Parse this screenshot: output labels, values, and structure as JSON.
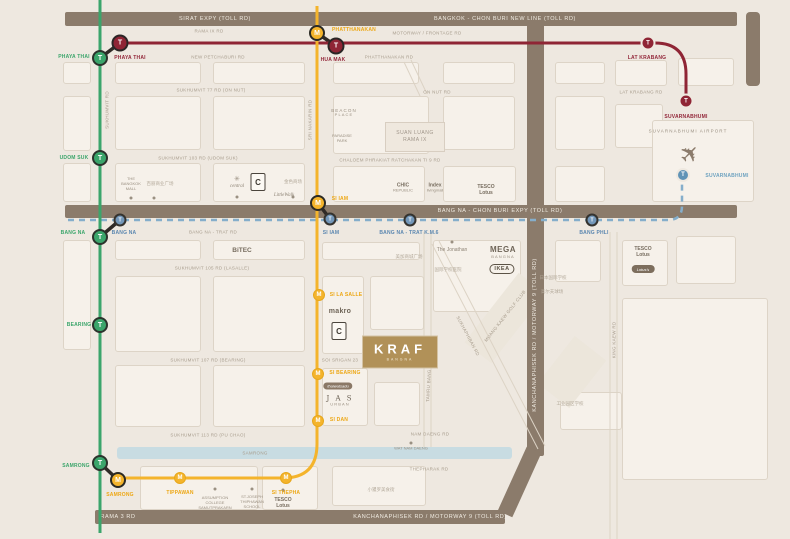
{
  "map": {
    "colors": {
      "green_line": "#3ba56b",
      "yellow_line": "#f4b42c",
      "airport_link": "#8f2535",
      "lrt_dashed": "#85aecb",
      "toll_road": "#8b7b6b",
      "brand_gold": "#b19158",
      "canal": "#c8dce2"
    },
    "bars": {
      "top_left": "SIRAT EXPY (TOLL RD)",
      "top_right": "BANGKOK - CHON BURI NEW LINE (TOLL RD)",
      "middle": "BANG NA - CHON BURI EXPY (TOLL RD)",
      "vertical": "KANCHANAPHISEK RD / MOTORWAY 9 (TOLL RD)",
      "bottom_left": "RAMA 3 RD",
      "bottom_right": "KANCHANAPHISEK RD / MOTORWAY 9 (TOLL RD)"
    },
    "logos": {
      "kraf": "KRAF",
      "kraf_sub": "BANGNA",
      "suan1": "SUAN LUANG",
      "suan2": "RAMA IX",
      "ikea": "IKEA",
      "bigc": "C",
      "lotus_oval": "Lotus's",
      "thaiwatsadu": "thaiwatsadu"
    },
    "icons": {
      "plane": "✈"
    },
    "streets": [
      {
        "t": "RAMA IX RD",
        "x": 209,
        "y": 31
      },
      {
        "t": "MOTORWAY / FRONTAGE RD",
        "x": 427,
        "y": 33
      },
      {
        "t": "NEW PETCHABURI RD",
        "x": 218,
        "y": 57
      },
      {
        "t": "PHATTHANAKAN RD",
        "x": 389,
        "y": 57
      },
      {
        "t": "SUKHUMVIT 77 RD (ON NUT)",
        "x": 211,
        "y": 90
      },
      {
        "t": "ON NUT RD",
        "x": 437,
        "y": 92
      },
      {
        "t": "LAT KRABANG RD",
        "x": 641,
        "y": 92
      },
      {
        "t": "SUKHUMVIT 103 RD (UDOM SUK)",
        "x": 198,
        "y": 158
      },
      {
        "t": "CHALOEM PHRAKIAT RATCHAKAN TI 9 RD",
        "x": 390,
        "y": 160
      },
      {
        "t": "BANG NA - TRAT RD",
        "x": 213,
        "y": 232
      },
      {
        "t": "SUKHUMVIT 105 RD (LASALLE)",
        "x": 212,
        "y": 268
      },
      {
        "t": "SUKHUMVIT 107 RD (BEARING)",
        "x": 208,
        "y": 360
      },
      {
        "t": "SOI SRIGAN 23",
        "x": 340,
        "y": 360
      },
      {
        "t": "SUKHUMVIT 113 RD (PU CHAO)",
        "x": 208,
        "y": 435
      },
      {
        "t": "NAM DAENG RD",
        "x": 430,
        "y": 434
      },
      {
        "t": "THEPHARAK RD",
        "x": 429,
        "y": 469
      },
      {
        "t": "SAMRONG",
        "x": 255,
        "y": 453
      },
      {
        "t": "SUKHUMVIT RD",
        "x": 107,
        "y": 110,
        "r": -90
      },
      {
        "t": "SRI NAKARIN RD",
        "x": 310,
        "y": 120,
        "r": -90
      },
      {
        "t": "TAMRU BANG PLA RD",
        "x": 429,
        "y": 376,
        "r": -87
      },
      {
        "t": "KING KAEW RD",
        "x": 614,
        "y": 340,
        "r": -90
      },
      {
        "t": "SUKHAPHIBAN RD",
        "x": 468,
        "y": 336,
        "r": 62
      },
      {
        "t": "MUANG KAEW GOLF CLUB",
        "x": 505,
        "y": 316,
        "r": -52
      }
    ],
    "stations": [
      {
        "id": "phaya-thai-bts",
        "t": "bts",
        "g": "T",
        "x": 100,
        "y": 58,
        "l": {
          "t": "PHAYA THAI",
          "x": 74,
          "y": 57,
          "c": "lg"
        }
      },
      {
        "id": "udom-suk",
        "t": "bts",
        "g": "T",
        "x": 100,
        "y": 158,
        "l": {
          "t": "UDOM SUK",
          "x": 74,
          "y": 158,
          "c": "lg"
        }
      },
      {
        "id": "bang-na-bts",
        "t": "bts",
        "g": "T",
        "x": 100,
        "y": 237,
        "l": {
          "t": "BANG NA",
          "x": 73,
          "y": 233,
          "c": "lg"
        }
      },
      {
        "id": "bearing",
        "t": "bts",
        "g": "T",
        "x": 100,
        "y": 325,
        "l": {
          "t": "BEARING",
          "x": 79,
          "y": 325,
          "c": "lg"
        }
      },
      {
        "id": "samrong-bts",
        "t": "bts",
        "g": "T",
        "x": 100,
        "y": 463,
        "l": {
          "t": "SAMRONG",
          "x": 76,
          "y": 466,
          "c": "lg"
        }
      },
      {
        "id": "phaya-thai-arl",
        "t": "arl",
        "g": "T",
        "x": 120,
        "y": 43,
        "l": {
          "t": "PHAYA THAI",
          "x": 130,
          "y": 58,
          "c": "lr"
        }
      },
      {
        "id": "hua-mak-arl",
        "t": "arl",
        "g": "T",
        "x": 336,
        "y": 46,
        "l": {
          "t": "HUA MAK",
          "x": 333,
          "y": 60,
          "c": "lr"
        }
      },
      {
        "id": "lat-krabang-arl",
        "t": "arl2",
        "g": "T",
        "x": 648,
        "y": 43,
        "l": {
          "t": "LAT KRABANG",
          "x": 647,
          "y": 58,
          "c": "lr"
        }
      },
      {
        "id": "suvarnabhumi-arl",
        "t": "arl2",
        "g": "T",
        "x": 686,
        "y": 101,
        "l": {
          "t": "SUVARNABHUMI",
          "x": 686,
          "y": 117,
          "c": "lr"
        }
      },
      {
        "id": "phatthanakan",
        "t": "m",
        "g": "M",
        "x": 317,
        "y": 33,
        "l": {
          "t": "PHATTHANAKAN",
          "x": 354,
          "y": 30,
          "c": "lo"
        }
      },
      {
        "id": "si-iam-m",
        "t": "m",
        "g": "M",
        "x": 318,
        "y": 203,
        "l": {
          "t": "SI IAM",
          "x": 340,
          "y": 199,
          "c": "lo"
        }
      },
      {
        "id": "si-la-salle",
        "t": "m2",
        "g": "M",
        "x": 319,
        "y": 295,
        "l": {
          "t": "SI LA SALLE",
          "x": 346,
          "y": 295,
          "c": "lo"
        }
      },
      {
        "id": "si-bearing",
        "t": "m2",
        "g": "M",
        "x": 318,
        "y": 374,
        "l": {
          "t": "SI BEARING",
          "x": 345,
          "y": 373,
          "c": "lo"
        }
      },
      {
        "id": "si-dan",
        "t": "m2",
        "g": "M",
        "x": 318,
        "y": 421,
        "l": {
          "t": "SI DAN",
          "x": 339,
          "y": 420,
          "c": "lo"
        }
      },
      {
        "id": "si-thepha",
        "t": "m2",
        "g": "M",
        "x": 286,
        "y": 478,
        "l": {
          "t": "SI THEPHA",
          "x": 286,
          "y": 493,
          "c": "lo"
        }
      },
      {
        "id": "tippawan",
        "t": "m2",
        "g": "M",
        "x": 180,
        "y": 478,
        "l": {
          "t": "TIPPAWAN",
          "x": 180,
          "y": 493,
          "c": "lo"
        }
      },
      {
        "id": "samrong-m",
        "t": "m",
        "g": "M",
        "x": 118,
        "y": 480,
        "l": {
          "t": "SAMRONG",
          "x": 120,
          "y": 495,
          "c": "lo"
        }
      },
      {
        "id": "bang-na-lrt",
        "t": "lrt",
        "g": "T",
        "x": 120,
        "y": 220,
        "l": {
          "t": "BANG NA",
          "x": 124,
          "y": 233,
          "c": "lb"
        }
      },
      {
        "id": "si-iam-lrt",
        "t": "lrt",
        "g": "T",
        "x": 330,
        "y": 219,
        "l": {
          "t": "SI IAM",
          "x": 331,
          "y": 233,
          "c": "lb"
        }
      },
      {
        "id": "bangna-trat-km6",
        "t": "lrt",
        "g": "T",
        "x": 410,
        "y": 220,
        "l": {
          "t": "BANG NA - TRAT K.M.6",
          "x": 409,
          "y": 233,
          "c": "lb"
        }
      },
      {
        "id": "bang-phli",
        "t": "lrt",
        "g": "T",
        "x": 592,
        "y": 220,
        "l": {
          "t": "BANG PHLI",
          "x": 594,
          "y": 233,
          "c": "lb"
        }
      },
      {
        "id": "suvarnabhumi-city",
        "t": "city",
        "g": "T",
        "x": 683,
        "y": 175,
        "l": {
          "t": "SUVARNABHUMI",
          "x": 727,
          "y": 176,
          "c": "lc"
        }
      }
    ],
    "pois": [
      {
        "n": "the-bangkok-mall",
        "x": 131,
        "y": 184,
        "lines": [
          {
            "t": "THE",
            "c": "t4"
          },
          {
            "t": "BANGKOK",
            "c": "t4"
          },
          {
            "t": "MALL",
            "c": "t4"
          }
        ]
      },
      {
        "n": "central",
        "x": 237,
        "y": 183,
        "lines": [
          {
            "t": "✳",
            "c": "flower"
          },
          {
            "t": "central",
            "c": "it"
          }
        ]
      },
      {
        "n": "little-walk",
        "x": 284,
        "y": 196,
        "lines": [
          {
            "t": "LittleWalk",
            "c": "it"
          }
        ]
      },
      {
        "n": "beacon-place",
        "x": 344,
        "y": 113,
        "lines": [
          {
            "t": "BEACON",
            "c": "t45 sp"
          },
          {
            "t": "PLACE",
            "c": "t4 sp"
          }
        ]
      },
      {
        "n": "paradise-park",
        "x": 342,
        "y": 139,
        "lines": [
          {
            "t": "PARADISE",
            "c": "t4"
          },
          {
            "t": "PARK",
            "c": "t4"
          }
        ]
      },
      {
        "n": "chic-republic",
        "x": 403,
        "y": 188,
        "lines": [
          {
            "t": "CHIC",
            "c": "b5"
          },
          {
            "t": "REPUBLIC",
            "c": "t4"
          }
        ]
      },
      {
        "n": "index-livingmall",
        "x": 435,
        "y": 188,
        "lines": [
          {
            "t": "Index",
            "c": "b5"
          },
          {
            "t": "livingmall",
            "c": "t4"
          }
        ]
      },
      {
        "n": "tesco-lotus-onnut",
        "x": 486,
        "y": 190,
        "lines": [
          {
            "t": "TESCO",
            "c": "b5"
          },
          {
            "t": "Lotus",
            "c": "b5"
          }
        ]
      },
      {
        "n": "bitec",
        "x": 242,
        "y": 251,
        "lines": [
          {
            "t": "BiTEC",
            "c": "b65"
          }
        ]
      },
      {
        "n": "the-jonathan",
        "x": 452,
        "y": 250,
        "lines": [
          {
            "t": "The Jonathan",
            "c": "t5"
          }
        ]
      },
      {
        "n": "mega-bangna",
        "x": 503,
        "y": 252,
        "lines": [
          {
            "t": "MEGA",
            "c": "b8"
          },
          {
            "t": "BANGNA",
            "c": "t4 sp"
          }
        ]
      },
      {
        "n": "tesco-lotus-east",
        "x": 643,
        "y": 252,
        "lines": [
          {
            "t": "TESCO",
            "c": "b5"
          },
          {
            "t": "Lotus",
            "c": "b5"
          }
        ]
      },
      {
        "n": "makro",
        "x": 340,
        "y": 312,
        "lines": [
          {
            "t": "makro",
            "c": "mk"
          }
        ]
      },
      {
        "n": "jas-urban",
        "x": 340,
        "y": 401,
        "lines": [
          {
            "t": "J A S",
            "c": "serif"
          },
          {
            "t": "URBAN",
            "c": "t4 sp"
          }
        ]
      },
      {
        "n": "assumption-college",
        "x": 215,
        "y": 503,
        "lines": [
          {
            "t": "ASSUMPTION",
            "c": "t4"
          },
          {
            "t": "COLLEGE",
            "c": "t4"
          },
          {
            "t": "SAMUTPRAKARN",
            "c": "t4"
          }
        ]
      },
      {
        "n": "st-joseph-school",
        "x": 252,
        "y": 502,
        "lines": [
          {
            "t": "ST.JOSEPH",
            "c": "t4"
          },
          {
            "t": "THIPHAWAN",
            "c": "t4"
          },
          {
            "t": "SCHOOL",
            "c": "t4"
          }
        ]
      },
      {
        "n": "tesco-lotus-south",
        "x": 283,
        "y": 503,
        "lines": [
          {
            "t": "TESCO",
            "c": "b5"
          },
          {
            "t": "Lotus",
            "c": "b5"
          }
        ]
      },
      {
        "n": "wat-nam-daeng",
        "x": 411,
        "y": 449,
        "lines": [
          {
            "t": "WAT NAM DAENG",
            "c": "t4"
          }
        ]
      },
      {
        "n": "suvarnabhumi-airport-label",
        "x": 688,
        "y": 131,
        "lines": [
          {
            "t": "SUVARNABHUMI AIRPORT",
            "c": "t45 sp"
          }
        ]
      }
    ],
    "cjk": [
      {
        "t": "百丽商业广场",
        "x": 160,
        "y": 184
      },
      {
        "t": "金色商场",
        "x": 293,
        "y": 182
      },
      {
        "t": "美加商城广场",
        "x": 409,
        "y": 257
      },
      {
        "t": "国际学校医院",
        "x": 448,
        "y": 270
      },
      {
        "t": "日本国际学校",
        "x": 553,
        "y": 278
      },
      {
        "t": "高尔夫球场",
        "x": 552,
        "y": 292
      },
      {
        "t": "小暹罗美食街",
        "x": 381,
        "y": 490
      },
      {
        "t": "工业园区学校",
        "x": 570,
        "y": 404
      }
    ],
    "blocks": [
      [
        63,
        62,
        28,
        22
      ],
      [
        115,
        62,
        86,
        22
      ],
      [
        213,
        62,
        92,
        22
      ],
      [
        333,
        62,
        86,
        22
      ],
      [
        443,
        62,
        72,
        22
      ],
      [
        555,
        62,
        50,
        22
      ],
      [
        615,
        60,
        52,
        26
      ],
      [
        678,
        58,
        56,
        28
      ],
      [
        63,
        96,
        28,
        55
      ],
      [
        115,
        96,
        86,
        54
      ],
      [
        213,
        96,
        92,
        54
      ],
      [
        333,
        96,
        96,
        58
      ],
      [
        443,
        96,
        72,
        54
      ],
      [
        555,
        96,
        50,
        54
      ],
      [
        615,
        104,
        48,
        44
      ],
      [
        652,
        120,
        102,
        82
      ],
      [
        63,
        163,
        28,
        39
      ],
      [
        115,
        163,
        86,
        39
      ],
      [
        213,
        163,
        92,
        39
      ],
      [
        333,
        166,
        92,
        36
      ],
      [
        443,
        166,
        73,
        36
      ],
      [
        555,
        166,
        50,
        36
      ],
      [
        63,
        240,
        28,
        110
      ],
      [
        115,
        240,
        86,
        20
      ],
      [
        213,
        240,
        92,
        20
      ],
      [
        322,
        242,
        98,
        18
      ],
      [
        433,
        240,
        88,
        72
      ],
      [
        555,
        240,
        46,
        42
      ],
      [
        622,
        240,
        46,
        46
      ],
      [
        676,
        236,
        60,
        48
      ],
      [
        115,
        276,
        86,
        76
      ],
      [
        213,
        276,
        92,
        76
      ],
      [
        322,
        276,
        42,
        78
      ],
      [
        370,
        276,
        54,
        54
      ],
      [
        115,
        365,
        86,
        62
      ],
      [
        213,
        365,
        92,
        62
      ],
      [
        322,
        368,
        46,
        58
      ],
      [
        374,
        382,
        46,
        44
      ],
      [
        140,
        466,
        118,
        44
      ],
      [
        262,
        466,
        56,
        44
      ],
      [
        332,
        466,
        94,
        40
      ],
      [
        560,
        392,
        62,
        38
      ],
      [
        622,
        298,
        146,
        182
      ]
    ],
    "diagblocks": [
      {
        "x": 505,
        "y": 318,
        "w": 34,
        "h": 88,
        "r": 38
      },
      {
        "x": 572,
        "y": 372,
        "w": 40,
        "h": 60,
        "r": 38
      }
    ],
    "dots": [
      [
        131,
        198
      ],
      [
        154,
        198
      ],
      [
        237,
        197
      ],
      [
        293,
        197
      ],
      [
        452,
        242
      ],
      [
        215,
        489
      ],
      [
        252,
        489
      ],
      [
        283,
        490
      ],
      [
        411,
        443
      ]
    ]
  }
}
